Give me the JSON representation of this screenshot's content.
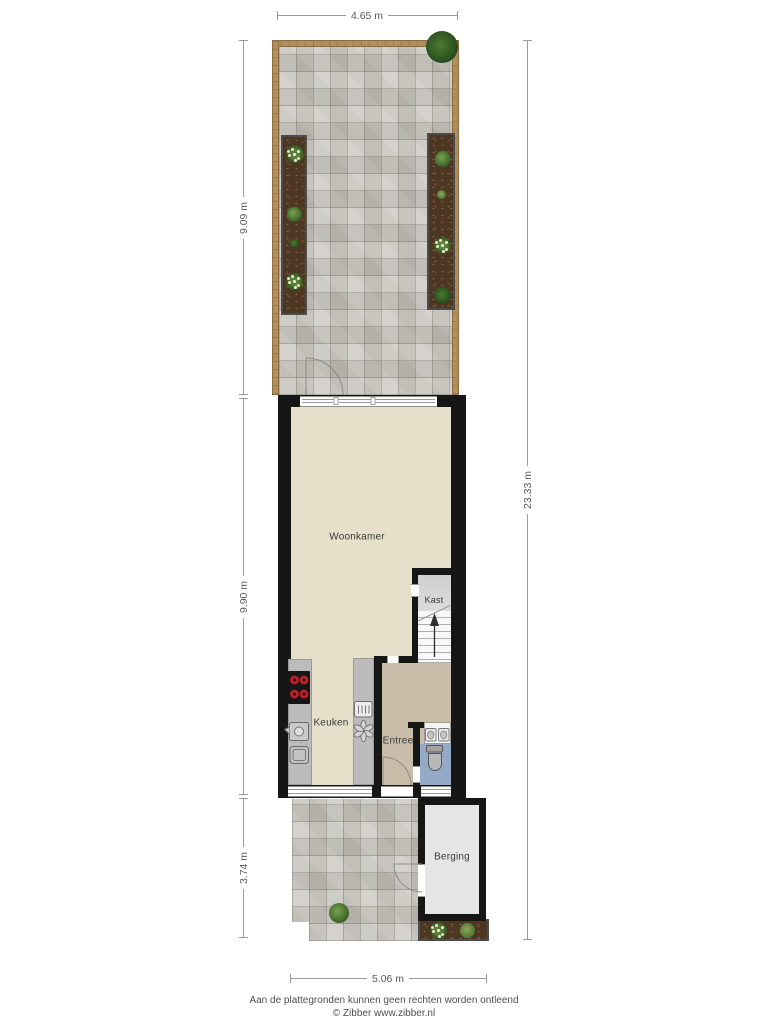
{
  "plan": {
    "type": "floorplan-ground-floor-with-garden",
    "rooms": {
      "woonkamer": "Woonkamer",
      "kast": "Kast",
      "keuken": "Keuken",
      "entree": "Entree",
      "berging": "Berging"
    },
    "dimensions": {
      "garden_width": "4.65 m",
      "garden_depth": "9.09 m",
      "house_depth": "9.90 m",
      "front_depth": "3.74 m",
      "total_depth": "23.33 m",
      "front_width": "5.06 m"
    },
    "icons": {
      "cooktop": "cooktop-icon",
      "sink": "sink-icon",
      "dishwasher": "dishwasher-icon",
      "oven": "oven-icon",
      "extractor": "extractor-fan-icon",
      "toilet": "toilet-icon",
      "hand_basin": "hand-basin-icon",
      "tree": "tree-icon",
      "bush": "bush-icon",
      "stairs_arrow": "stairs-up-arrow"
    },
    "colors": {
      "wall": "#161616",
      "floor_living": "#e6dfca",
      "floor_hall": "#c9bca9",
      "floor_wc": "#94aac6",
      "floor_closet": "#d6d6d6",
      "floor_storage": "#e5e5e5",
      "kitchen_counter": "#bcbcbc",
      "burner_red": "#b6272c",
      "paving": "#c9c6c0",
      "fence": "#b2905d",
      "soil": "#4e3722",
      "dimension_line": "#9b9b9b"
    }
  },
  "footer": {
    "disclaimer": "Aan de plattegronden kunnen geen rechten worden ontleend",
    "copyright": "© Zibber www.zibber.nl"
  }
}
